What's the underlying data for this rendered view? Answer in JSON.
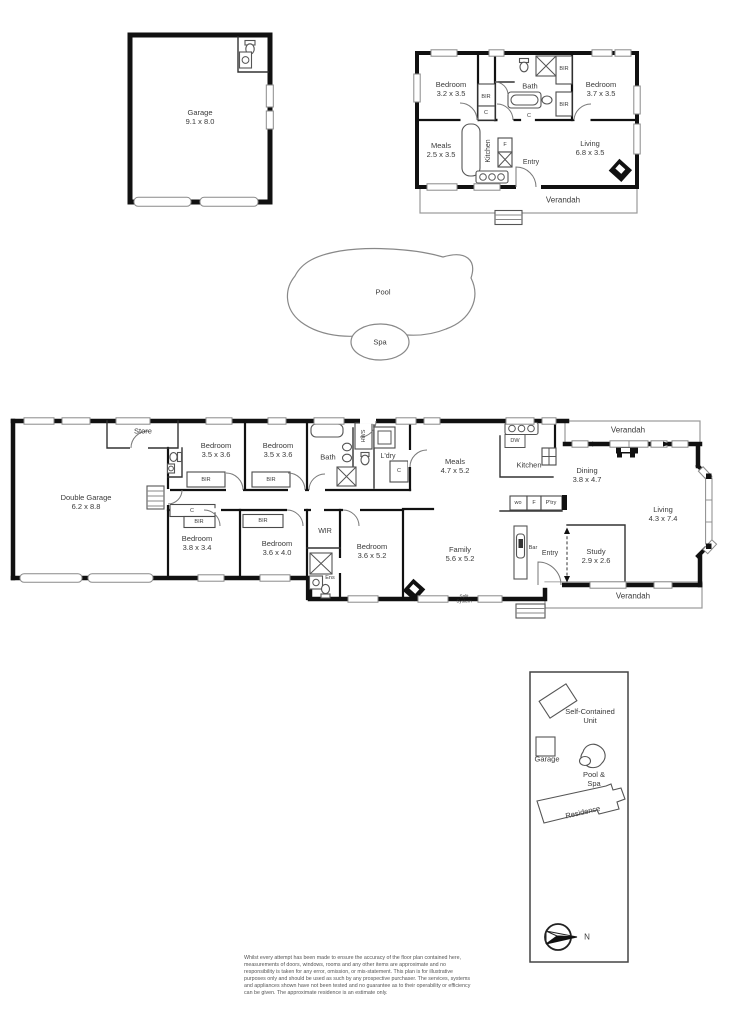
{
  "outbuilding_garage": {
    "name": "Garage",
    "dims": "9.1 x 8.0"
  },
  "unit": {
    "bedroom1": {
      "name": "Bedroom",
      "dims": "3.2 x 3.5"
    },
    "bedroom2": {
      "name": "Bedroom",
      "dims": "3.7 x 3.5"
    },
    "bath": "Bath",
    "meals": {
      "name": "Meals",
      "dims": "2.5 x 3.5"
    },
    "kitchen": "Kitchen",
    "fridge": "F",
    "entry": "Entry",
    "living": {
      "name": "Living",
      "dims": "6.8 x 3.5"
    },
    "bir_bed1": "BIR",
    "closet_bed1": "C",
    "bir_shower": "BIR",
    "bir_basin": "BIR",
    "closet_bath": "C",
    "verandah": "Verandah"
  },
  "pool": {
    "pool": "Pool",
    "spa": "Spa"
  },
  "residence": {
    "store": "Store",
    "double_garage": {
      "name": "Double Garage",
      "dims": "6.2 x 8.8"
    },
    "bedroom1": {
      "name": "Bedroom",
      "dims": "3.5 x 3.6"
    },
    "bir1": "BIR",
    "bedroom2": {
      "name": "Bedroom",
      "dims": "3.5 x 3.6"
    },
    "bir2": "BIR",
    "bath": "Bath",
    "hws": "HWS",
    "laundry": "L'dry",
    "laundry_closet": "C",
    "meals": {
      "name": "Meals",
      "dims": "4.7 x 5.2"
    },
    "kitchen": "Kitchen",
    "dishwasher": "DW",
    "verandah_top": "Verandah",
    "dining": {
      "name": "Dining",
      "dims": "3.8 x 4.7"
    },
    "living": {
      "name": "Living",
      "dims": "4.3 x 7.4"
    },
    "wall_oven": "wo",
    "fridge": "F",
    "pantry": "P'try",
    "bedroom3": {
      "name": "Bedroom",
      "dims": "3.8 x 3.4"
    },
    "closet3": "C",
    "bir3": "BIR",
    "bedroom4": {
      "name": "Bedroom",
      "dims": "3.6 x 4.0"
    },
    "bir4": "BIR",
    "wir": "WIR",
    "ensuite": "Ens",
    "bedroom5": {
      "name": "Bedroom",
      "dims": "3.6 x 5.2"
    },
    "family": {
      "name": "Family",
      "dims": "5.6 x 5.2"
    },
    "bar": "Bar",
    "entry": "Entry",
    "study": {
      "name": "Study",
      "dims": "2.9 x 2.6"
    },
    "split_system": "Split System",
    "verandah_bottom": "Verandah"
  },
  "site_key": {
    "unit": "Self-Contained Unit",
    "garage": "Garage",
    "pool_spa": "Pool & Spa",
    "residence": "Residence",
    "north": "N"
  },
  "disclaimer": "Whilst every attempt has been made to ensure the accuracy of the floor plan contained here, measurements of doors, windows, rooms and any other items are approximate and no responsibility is taken for any error, omission, or mis-statement.  This plan is for illustrative purposes only and should be used as such by any prospective purchaser.  The services, systems and appliances shown have not been tested and no guarantee as to their operability or efficiency can be given.  The approximate residence is an estimate only."
}
